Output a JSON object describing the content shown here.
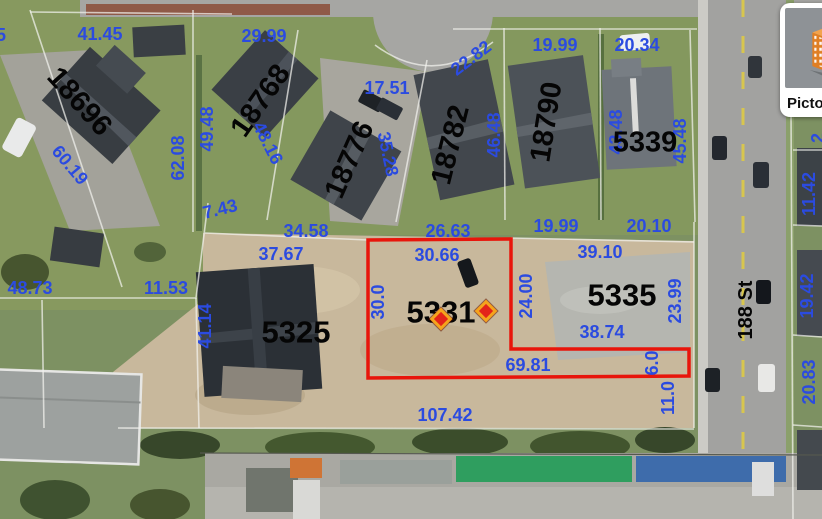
{
  "map": {
    "street_label": {
      "t": "188 St",
      "x": 746,
      "y": 310,
      "r": -90,
      "s": 20
    },
    "lot_number_labels": [
      {
        "t": "18696",
        "x": 79,
        "y": 102,
        "r": 48,
        "s": 29
      },
      {
        "t": "18768",
        "x": 261,
        "y": 101,
        "r": -55,
        "s": 29
      },
      {
        "t": "18776",
        "x": 350,
        "y": 160,
        "r": -66,
        "s": 29
      },
      {
        "t": "18782",
        "x": 451,
        "y": 145,
        "r": -76,
        "s": 29
      },
      {
        "t": "18790",
        "x": 547,
        "y": 122,
        "r": -81,
        "s": 29
      },
      {
        "t": "5339",
        "x": 645,
        "y": 143,
        "r": 0,
        "s": 29
      },
      {
        "t": "5325",
        "x": 296,
        "y": 332,
        "r": 0,
        "s": 31
      },
      {
        "t": "5331",
        "x": 441,
        "y": 312,
        "r": 0,
        "s": 31
      },
      {
        "t": "5335",
        "x": 622,
        "y": 295,
        "r": 0,
        "s": 31
      }
    ],
    "dimension_labels": [
      {
        "t": "41.45",
        "x": 100,
        "y": 34,
        "r": 0
      },
      {
        "t": "29.99",
        "x": 264,
        "y": 36,
        "r": 0
      },
      {
        "t": "19.99",
        "x": 555,
        "y": 45,
        "r": 0
      },
      {
        "t": "20.34",
        "x": 637,
        "y": 45,
        "r": 0
      },
      {
        "t": "22.82",
        "x": 471,
        "y": 58,
        "r": -37
      },
      {
        "t": "17.51",
        "x": 387,
        "y": 88,
        "r": 0
      },
      {
        "t": "62.08",
        "x": 178,
        "y": 158,
        "r": -90
      },
      {
        "t": "49.48",
        "x": 207,
        "y": 129,
        "r": -90
      },
      {
        "t": "48.16",
        "x": 268,
        "y": 143,
        "r": 63
      },
      {
        "t": "35.28",
        "x": 388,
        "y": 154,
        "r": 78
      },
      {
        "t": "46.48",
        "x": 494,
        "y": 135,
        "r": -90
      },
      {
        "t": "43.48",
        "x": 616,
        "y": 132,
        "r": -90
      },
      {
        "t": "45.48",
        "x": 680,
        "y": 141,
        "r": -90
      },
      {
        "t": "60.19",
        "x": 70,
        "y": 165,
        "r": 50
      },
      {
        "t": "7.43",
        "x": 220,
        "y": 209,
        "r": -14
      },
      {
        "t": "34.58",
        "x": 306,
        "y": 231,
        "r": 0
      },
      {
        "t": "26.63",
        "x": 448,
        "y": 231,
        "r": 0
      },
      {
        "t": "19.99",
        "x": 556,
        "y": 226,
        "r": 0
      },
      {
        "t": "20.10",
        "x": 649,
        "y": 226,
        "r": 0
      },
      {
        "t": "48.73",
        "x": 30,
        "y": 288,
        "r": 0
      },
      {
        "t": "11.53",
        "x": 166,
        "y": 288,
        "r": 0
      },
      {
        "t": "37.67",
        "x": 281,
        "y": 254,
        "r": 0
      },
      {
        "t": "30.66",
        "x": 437,
        "y": 255,
        "r": 0
      },
      {
        "t": "39.10",
        "x": 600,
        "y": 252,
        "r": 0
      },
      {
        "t": "41.14",
        "x": 205,
        "y": 326,
        "r": -90
      },
      {
        "t": "30.0",
        "x": 378,
        "y": 302,
        "r": -90
      },
      {
        "t": "24.00",
        "x": 526,
        "y": 296,
        "r": -90
      },
      {
        "t": "23.99",
        "x": 675,
        "y": 301,
        "r": -90
      },
      {
        "t": "38.74",
        "x": 602,
        "y": 332,
        "r": 0
      },
      {
        "t": "69.81",
        "x": 528,
        "y": 365,
        "r": 0
      },
      {
        "t": "6.0",
        "x": 652,
        "y": 363,
        "r": -90
      },
      {
        "t": "11.0",
        "x": 668,
        "y": 398,
        "r": -90
      },
      {
        "t": "107.42",
        "x": 445,
        "y": 415,
        "r": 0
      },
      {
        "t": "11.42",
        "x": 809,
        "y": 194,
        "r": -90
      },
      {
        "t": "19.42",
        "x": 807,
        "y": 296,
        "r": -90
      },
      {
        "t": "20.83",
        "x": 809,
        "y": 382,
        "r": -90
      },
      {
        "t": "5",
        "x": 1,
        "y": 35,
        "r": 0
      },
      {
        "t": "2",
        "x": 818,
        "y": 138,
        "r": -90
      }
    ],
    "red_parcel": {
      "lot": "5331",
      "points": "368,240 511,239 511,349 689,349 689,376 368,378"
    },
    "markers": [
      {
        "x": 441,
        "y": 319
      },
      {
        "x": 486,
        "y": 311
      }
    ],
    "colors": {
      "label_blue": "#2b4be0",
      "label_black": "#050505",
      "parcel_red": "#e8150b",
      "marker_fill": "#e3241a",
      "marker_border": "#f4a41d",
      "pictometry_orange": "#e07f24"
    }
  },
  "pictometry": {
    "label": "Pictometry"
  }
}
